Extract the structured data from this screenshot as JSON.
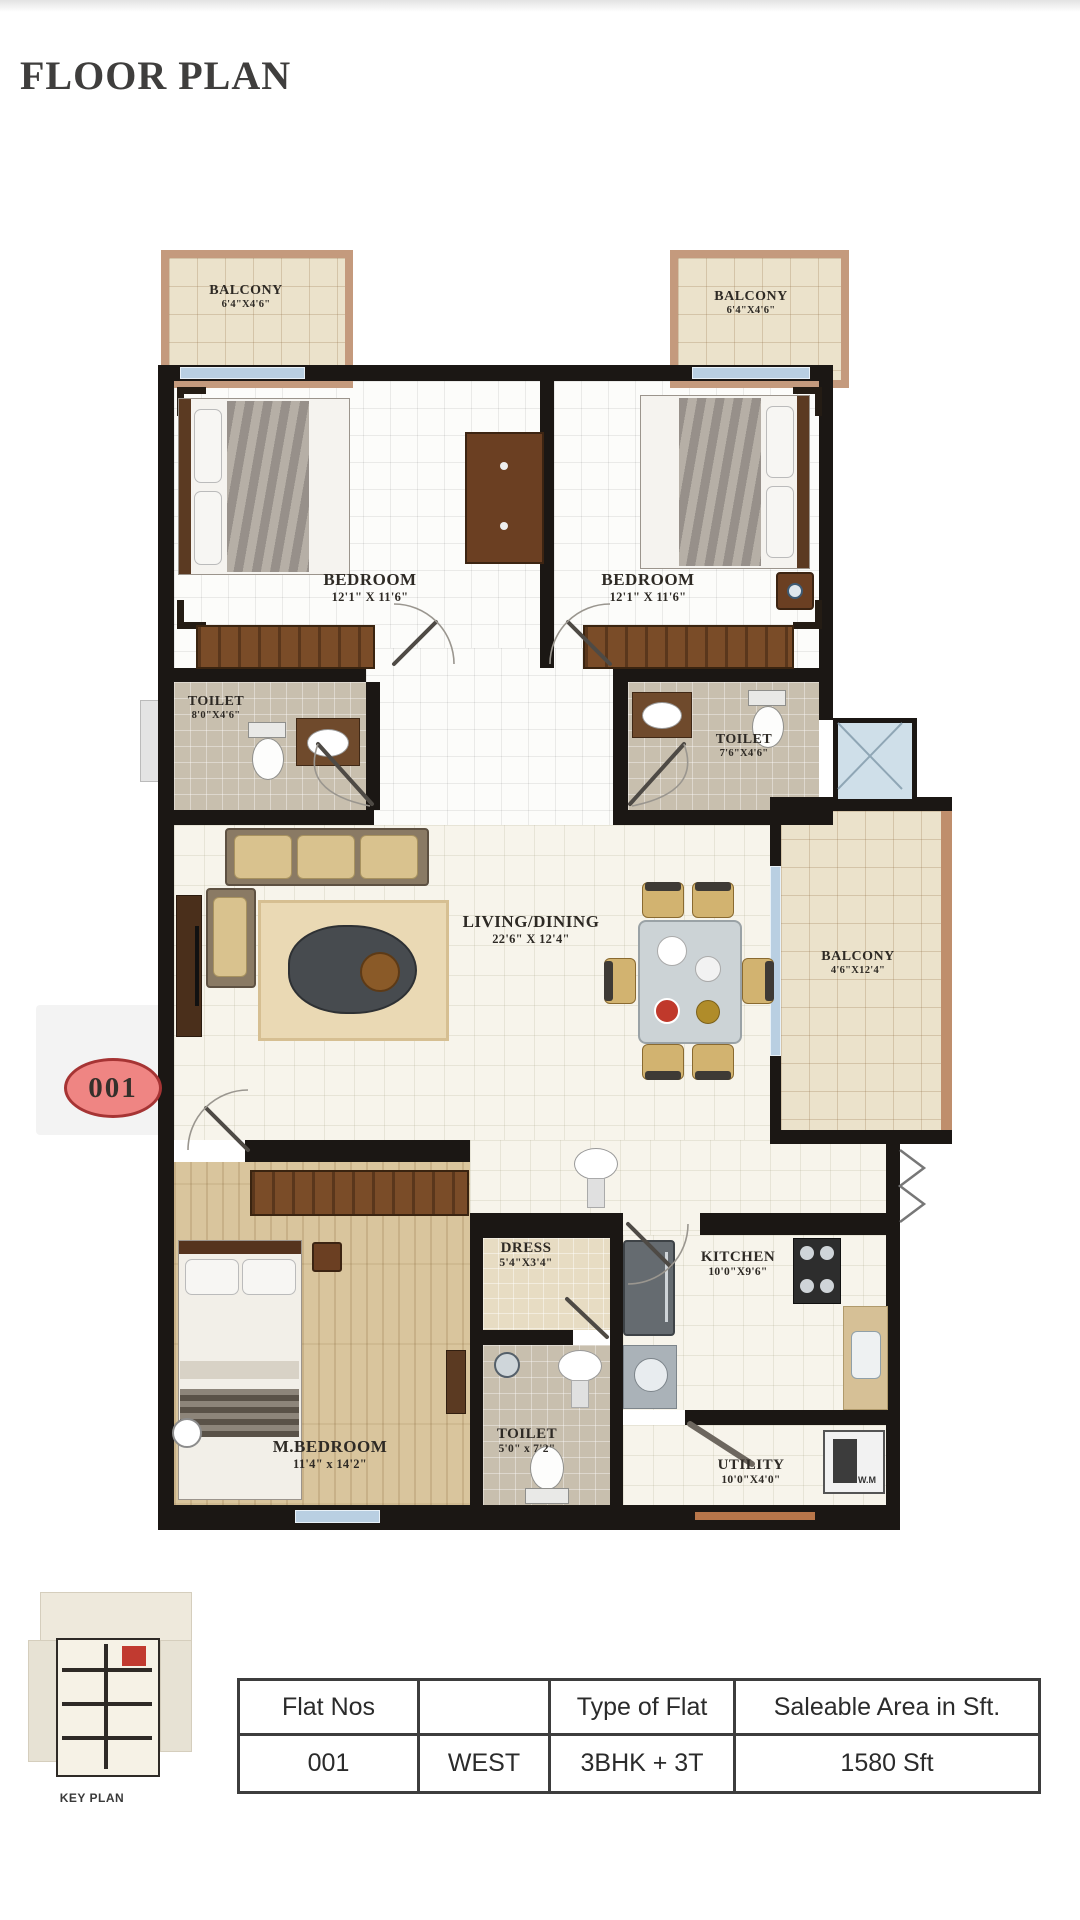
{
  "page": {
    "title": "FLOOR PLAN"
  },
  "badge": {
    "label": "001"
  },
  "rooms": {
    "balcony_top_left": {
      "name": "BALCONY",
      "dims": "6'4\"X4'6\""
    },
    "balcony_top_right": {
      "name": "BALCONY",
      "dims": "6'4\"X4'6\""
    },
    "bedroom_left": {
      "name": "BEDROOM",
      "dims": "12'1\" X 11'6\""
    },
    "bedroom_right": {
      "name": "BEDROOM",
      "dims": "12'1\" X 11'6\""
    },
    "toilet_left": {
      "name": "TOILET",
      "dims": "8'0\"X4'6\""
    },
    "toilet_right": {
      "name": "TOILET",
      "dims": "7'6\"X4'6\""
    },
    "living_dining": {
      "name": "LIVING/DINING",
      "dims": "22'6\" X 12'4\""
    },
    "balcony_right": {
      "name": "BALCONY",
      "dims": "4'6\"X12'4\""
    },
    "dress": {
      "name": "DRESS",
      "dims": "5'4\"X3'4\""
    },
    "kitchen": {
      "name": "KITCHEN",
      "dims": "10'0\"X9'6\""
    },
    "toilet_master": {
      "name": "TOILET",
      "dims": "5'0\" x 7'2\""
    },
    "master_bedroom": {
      "name": "M.BEDROOM",
      "dims": "11'4\" x 14'2\""
    },
    "utility": {
      "name": "UTILITY",
      "dims": "10'0\"X4'0\""
    }
  },
  "appliances": {
    "washing_machine": "W.M"
  },
  "key_plan": {
    "caption": "KEY PLAN"
  },
  "table": {
    "headers": [
      "Flat Nos",
      "",
      "Type of Flat",
      "Saleable Area in Sft."
    ],
    "row": [
      "001",
      "WEST",
      "3BHK + 3T",
      "1580 Sft"
    ]
  },
  "colors": {
    "wall": "#1b1714",
    "badge_fill": "#ef8583",
    "badge_border": "#a63434",
    "wood_frame": "#c49a7d",
    "accent_blue": "#b9cfe2",
    "keyplan_red": "#c13a30"
  }
}
